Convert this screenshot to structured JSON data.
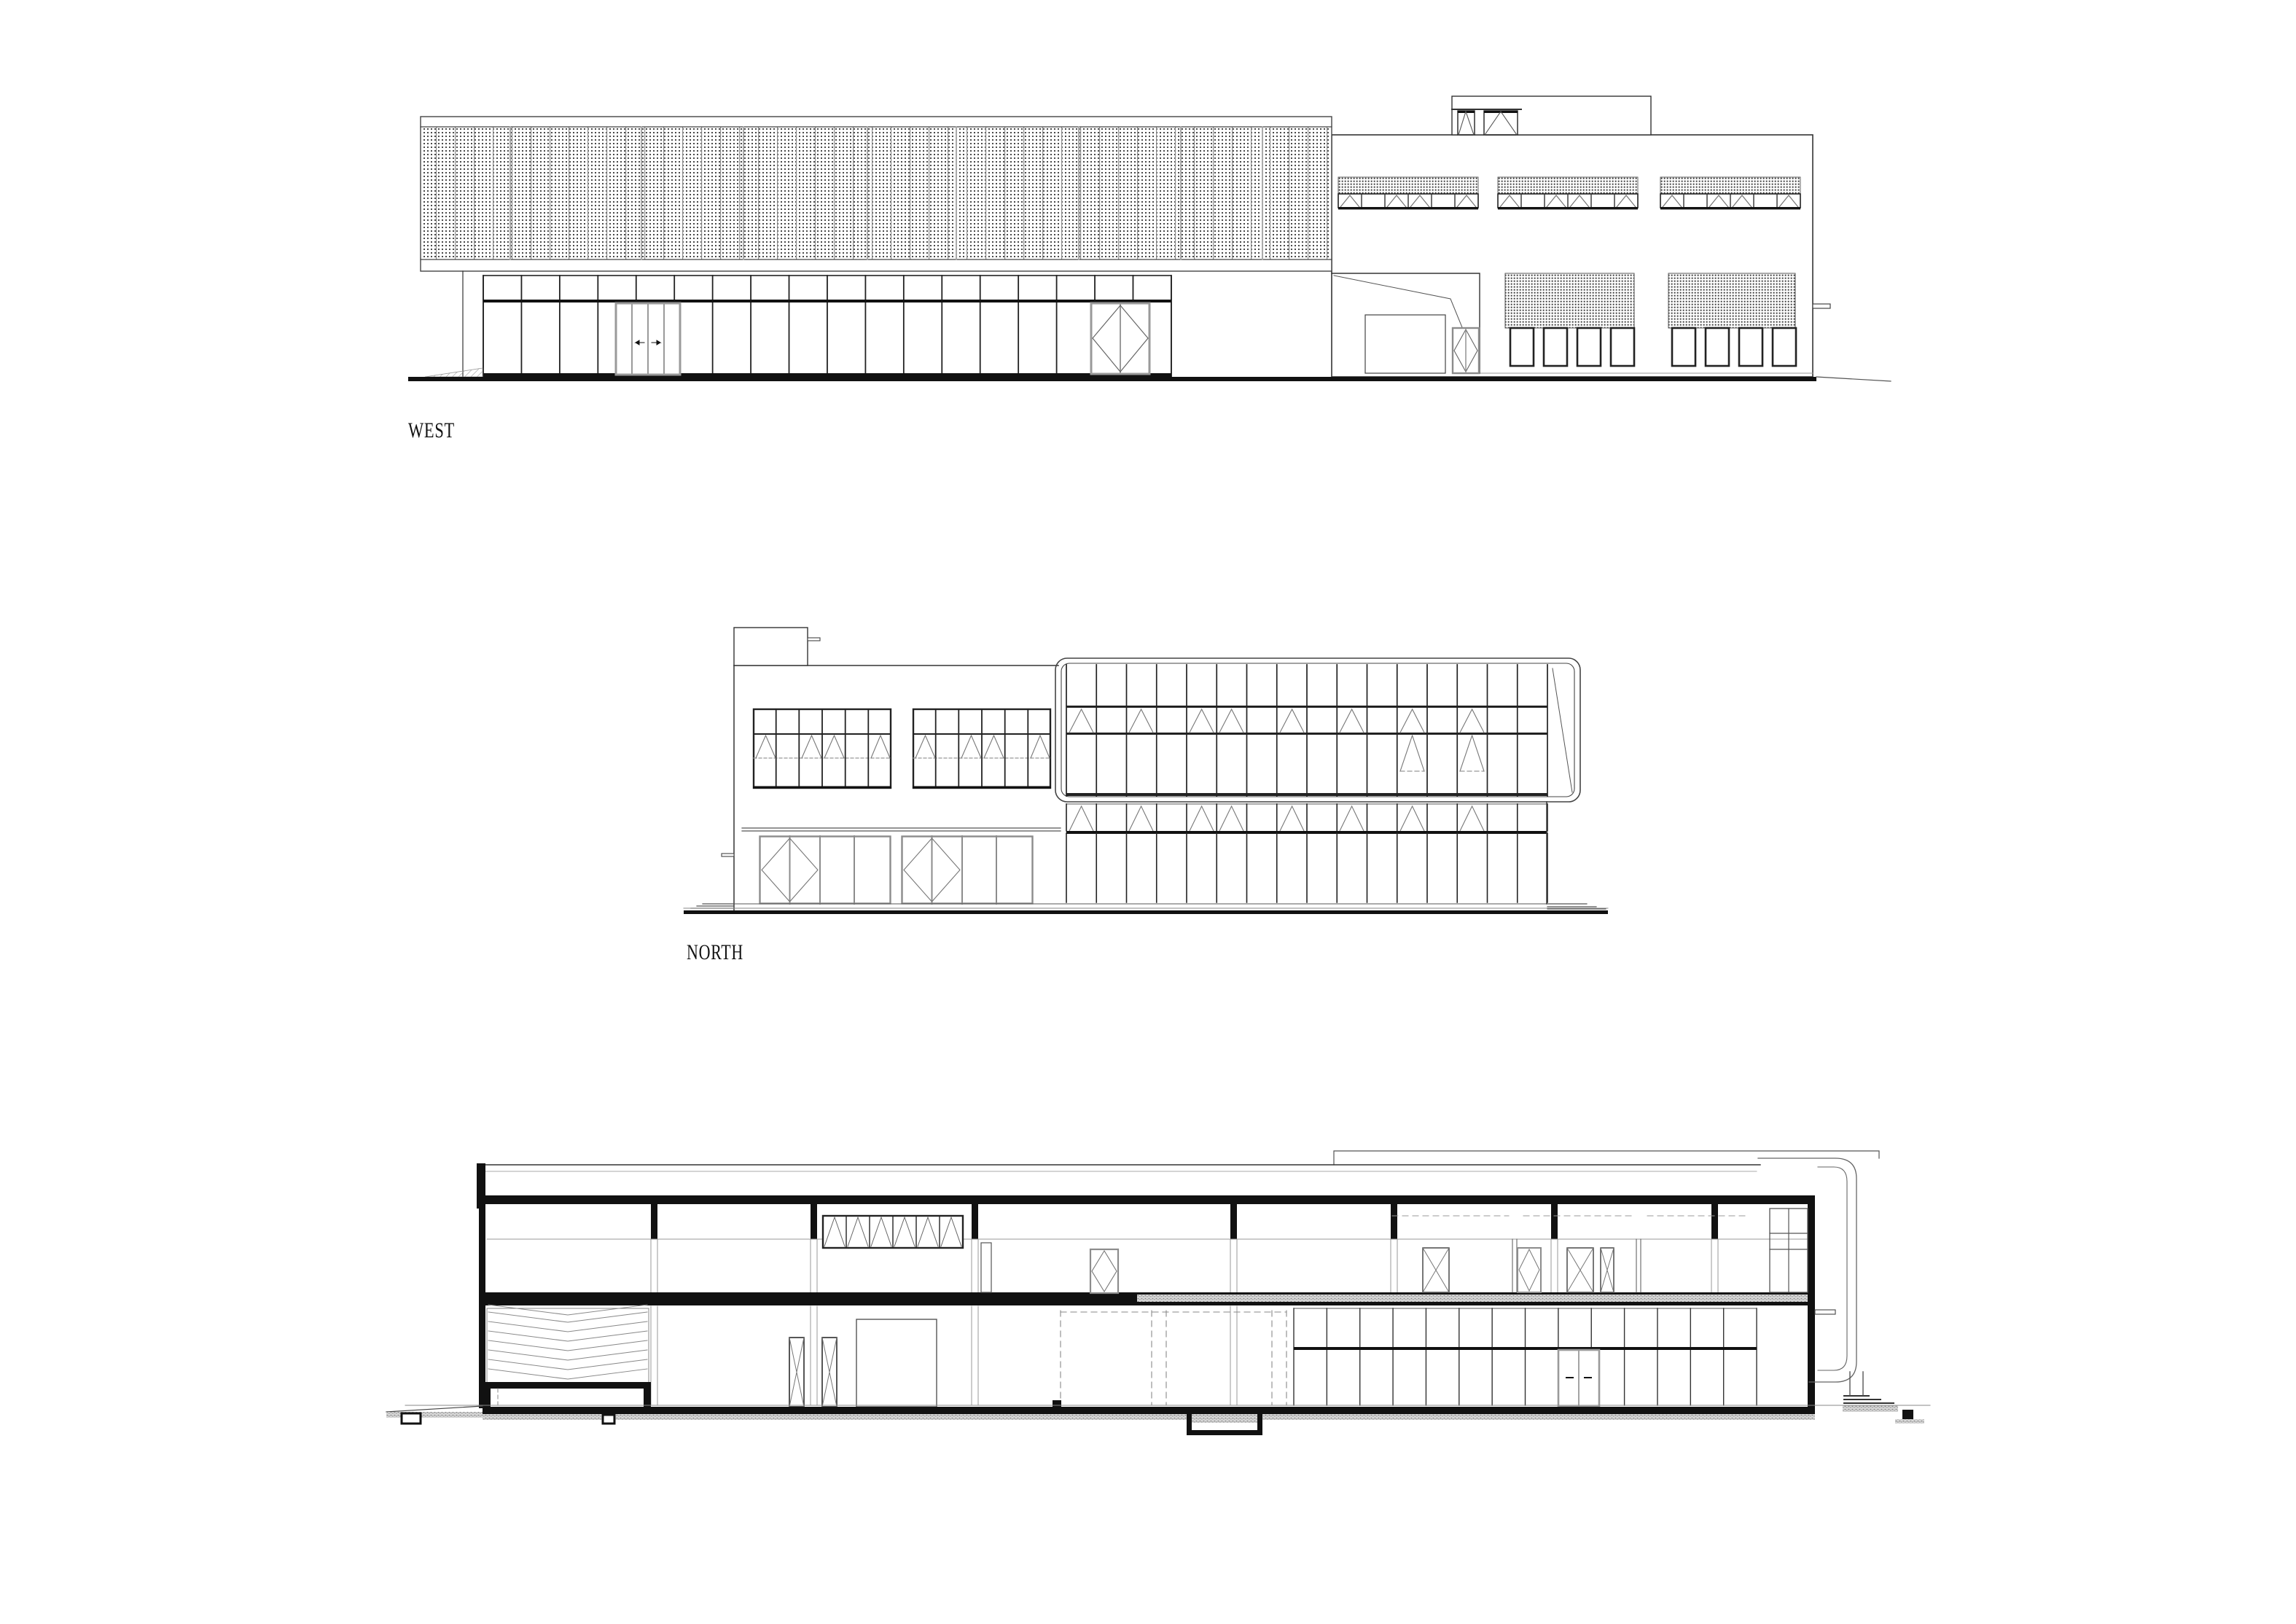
{
  "sheet": {
    "background": "#ffffff",
    "ink": "#1a1a1a",
    "frame_gray": "#8c8c8c",
    "hatch_gray": "#555555"
  },
  "drawings": {
    "west": {
      "label": "WEST"
    },
    "north": {
      "label": "NORTH"
    },
    "section": {
      "label": ""
    }
  }
}
